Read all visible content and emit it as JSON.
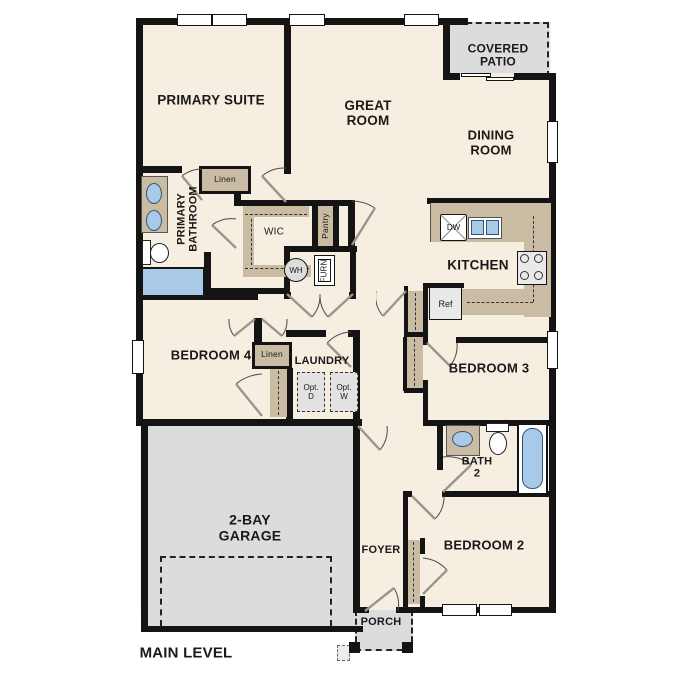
{
  "plan": {
    "level_label": "MAIN LEVEL",
    "rooms": {
      "primary_suite": "PRIMARY SUITE",
      "great_room": "GREAT ROOM",
      "covered_patio": "COVERED PATIO",
      "dining_room": "DINING ROOM",
      "primary_bathroom": "PRIMARY BATHROOM",
      "wic": "WIC",
      "kitchen": "KITCHEN",
      "bedroom4": "BEDROOM 4",
      "laundry": "LAUNDRY",
      "bedroom3": "BEDROOM 3",
      "bath2": "BATH 2",
      "garage": "2-BAY GARAGE",
      "foyer": "FOYER",
      "bedroom2": "BEDROOM 2",
      "porch": "PORCH"
    },
    "closets": {
      "pantry": "Pantry",
      "linen_upper": "Linen",
      "linen_lower": "Linen"
    },
    "appliances": {
      "wh": "WH",
      "furn": "FURN",
      "dw": "DW",
      "ref": "Ref",
      "opt_d": "Opt. D",
      "opt_w": "Opt. W"
    },
    "colors": {
      "wall": "#141414",
      "floor": "#f6eee0",
      "exterior_concrete": "#dcdcdc",
      "cabinetry": "#c9bca3",
      "fixture_blue": "#a9c9e9"
    }
  }
}
